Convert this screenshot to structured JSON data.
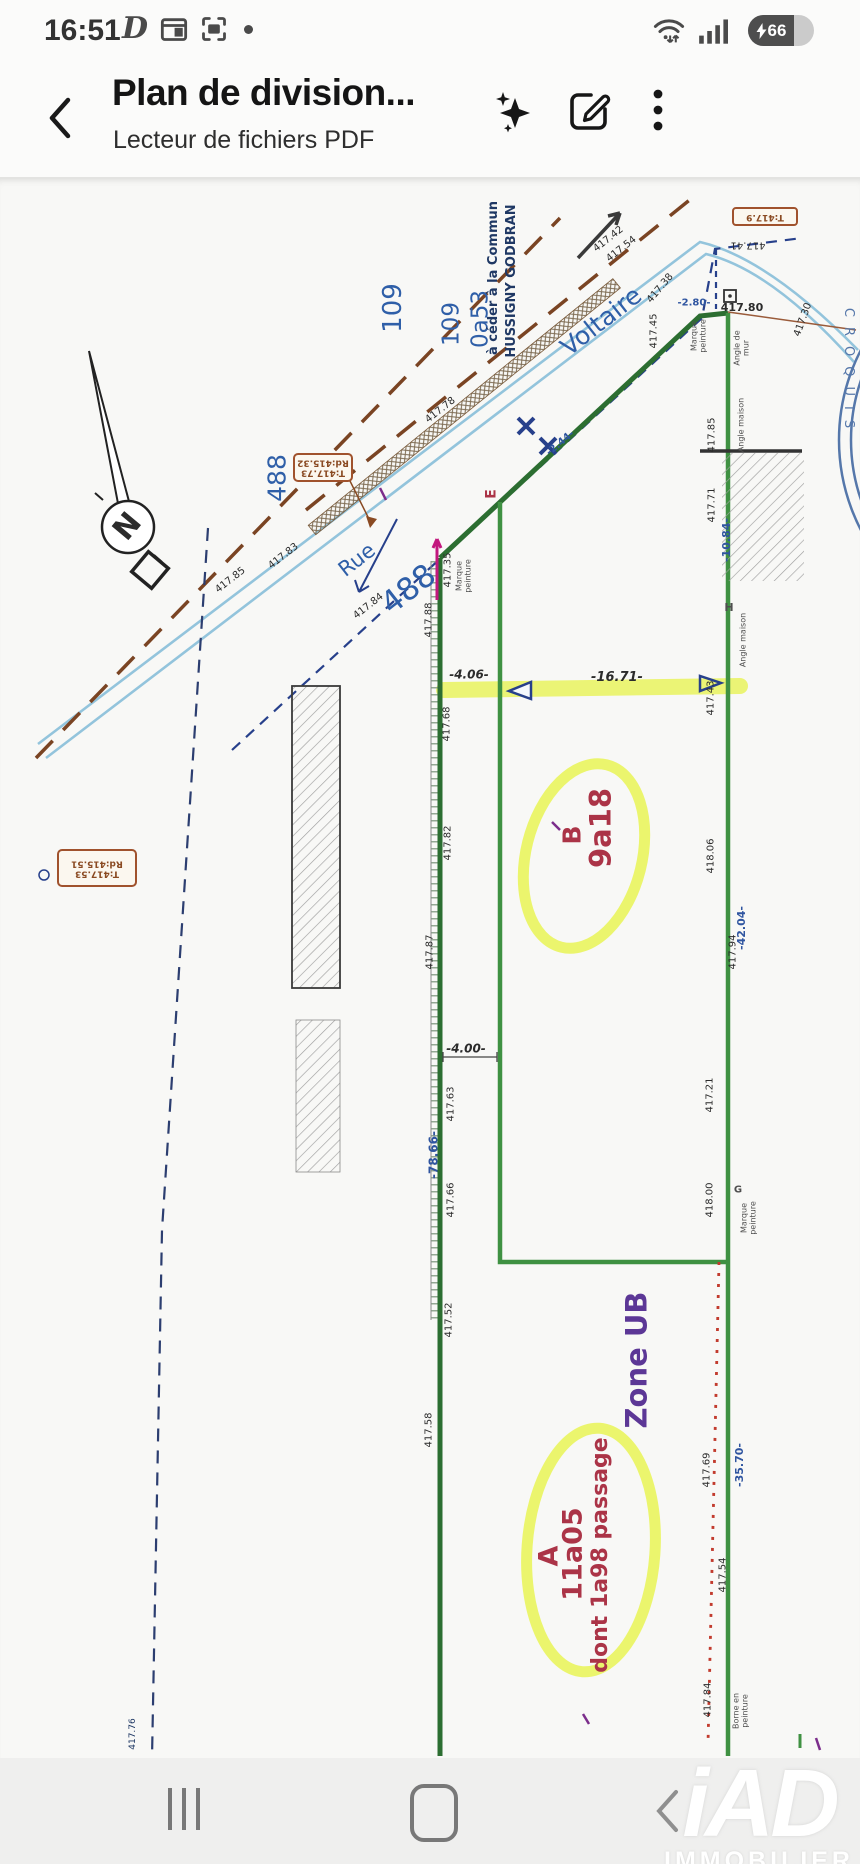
{
  "status_bar": {
    "time": "16:51",
    "battery_percent": "66"
  },
  "header": {
    "title": "Plan de division...",
    "subtitle": "Lecteur de fichiers PDF"
  },
  "watermark": {
    "brand": "iAD",
    "caption": "IMMOBILIER"
  },
  "colors": {
    "blue": "#2f5fa8",
    "navy": "#1f3864",
    "mblue": "#2f55a0",
    "red": "#ab3447",
    "purple": "#5c3796",
    "black": "#2b2b2b",
    "gray": "#4f4f4f",
    "brown": "#8a4a22",
    "stamp": "#5577aa",
    "boundary_green": "#2c6e31",
    "boundary_green_light": "#3f9142",
    "highlight_yellow": "#e9f455",
    "road_blue": "#93c4dc",
    "dashed_brown": "#7a4423",
    "red_dash": "#c23b2e",
    "magenta": "#c2187e"
  },
  "plan": {
    "labels": [
      {
        "t": "109",
        "x": 393,
        "y": 130,
        "r": -90,
        "s": 26,
        "c": "blue",
        "n": "parcel-109-a"
      },
      {
        "t": "109",
        "x": 452,
        "y": 146,
        "r": -90,
        "s": 23,
        "c": "blue",
        "n": "parcel-109-b"
      },
      {
        "t": "0a53",
        "x": 481,
        "y": 141,
        "r": -90,
        "s": 23,
        "c": "blue",
        "n": "parcel-0a53"
      },
      {
        "t": "à céder à la Commun",
        "x": 494,
        "y": 100,
        "r": -90,
        "s": 13,
        "c": "navy",
        "w": 600,
        "n": "note-a-ceder"
      },
      {
        "t": "HUSSIGNY GODBRAN",
        "x": 512,
        "y": 103,
        "r": -90,
        "s": 13,
        "c": "navy",
        "w": 700,
        "n": "note-hussigny"
      },
      {
        "t": "Voltaire",
        "x": 601,
        "y": 143,
        "r": -38,
        "s": 25,
        "c": "blue",
        "n": "street-voltaire"
      },
      {
        "t": "Rue",
        "x": 357,
        "y": 382,
        "r": -38,
        "s": 21,
        "c": "blue",
        "n": "street-rue"
      },
      {
        "t": "488",
        "x": 277,
        "y": 300,
        "r": -90,
        "s": 25,
        "c": "blue",
        "n": "parcel-488-a"
      },
      {
        "t": "488",
        "x": 409,
        "y": 412,
        "r": -38,
        "s": 31,
        "c": "blue",
        "n": "parcel-488-b"
      },
      {
        "t": "E",
        "x": 492,
        "y": 316,
        "r": -90,
        "s": 14,
        "c": "red",
        "w": 700,
        "n": "point-e"
      },
      {
        "t": "B",
        "x": 572,
        "y": 657,
        "r": -90,
        "s": 25,
        "c": "red",
        "w": 700,
        "n": "parcel-b"
      },
      {
        "t": "9a18",
        "x": 601,
        "y": 650,
        "r": -90,
        "s": 29,
        "c": "red",
        "w": 700,
        "n": "parcel-b-area"
      },
      {
        "t": "Zone UB",
        "x": 637,
        "y": 1182,
        "r": -90,
        "s": 29,
        "c": "purple",
        "w": 600,
        "n": "zone-ub"
      },
      {
        "t": "A",
        "x": 549,
        "y": 1378,
        "r": -90,
        "s": 27,
        "c": "red",
        "w": 700,
        "n": "parcel-a"
      },
      {
        "t": "11a05",
        "x": 573,
        "y": 1376,
        "r": -90,
        "s": 27,
        "c": "red",
        "w": 700,
        "n": "parcel-a-area"
      },
      {
        "t": "dont 1a98 passage",
        "x": 601,
        "y": 1377,
        "r": -90,
        "s": 22,
        "c": "red",
        "w": 700,
        "n": "parcel-a-passage"
      },
      {
        "t": "-4.06-",
        "x": 469,
        "y": 497,
        "r": 0,
        "s": 12,
        "c": "black",
        "w": 700,
        "i": 1,
        "n": "dim-4-06"
      },
      {
        "t": "-16.71-",
        "x": 617,
        "y": 500,
        "r": 0,
        "s": 13,
        "c": "black",
        "w": 700,
        "i": 1,
        "n": "dim-16-71"
      },
      {
        "t": "-4.00-",
        "x": 466,
        "y": 871,
        "r": 0,
        "s": 12,
        "c": "black",
        "w": 700,
        "i": 1,
        "n": "dim-4-00"
      },
      {
        "t": "-2.80-",
        "x": 694,
        "y": 126,
        "r": 0,
        "s": 10,
        "c": "mblue",
        "w": 700,
        "n": "dim-2-80"
      },
      {
        "t": "-2.44-",
        "x": 561,
        "y": 266,
        "r": -40,
        "s": 10,
        "c": "mblue",
        "w": 700,
        "n": "dim-2-44"
      },
      {
        "t": "-10.84-",
        "x": 727,
        "y": 362,
        "r": -90,
        "s": 11,
        "c": "mblue",
        "w": 700,
        "n": "dim-10-84"
      },
      {
        "t": "-42.04-",
        "x": 742,
        "y": 750,
        "r": -90,
        "s": 11,
        "c": "mblue",
        "w": 700,
        "n": "dim-42-04"
      },
      {
        "t": "-78.66-",
        "x": 434,
        "y": 977,
        "r": -90,
        "s": 12,
        "c": "mblue",
        "w": 700,
        "n": "dim-78-66"
      },
      {
        "t": "-35.70-",
        "x": 740,
        "y": 1287,
        "r": -90,
        "s": 11,
        "c": "mblue",
        "w": 700,
        "n": "dim-35-70"
      },
      {
        "t": "417.42",
        "x": 609,
        "y": 62,
        "r": -38,
        "s": 10,
        "c": "black"
      },
      {
        "t": "417.54",
        "x": 622,
        "y": 72,
        "r": -38,
        "s": 10,
        "c": "black"
      },
      {
        "t": "417.41",
        "x": 748,
        "y": 66,
        "r": 180,
        "s": 10,
        "c": "black"
      },
      {
        "t": "417.38",
        "x": 661,
        "y": 111,
        "r": -50,
        "s": 10,
        "c": "black"
      },
      {
        "t": "417.80",
        "x": 742,
        "y": 130,
        "r": 0,
        "s": 11,
        "c": "black",
        "w": 600
      },
      {
        "t": "417.30",
        "x": 804,
        "y": 142,
        "r": -70,
        "s": 10,
        "c": "black"
      },
      {
        "t": "417.45",
        "x": 655,
        "y": 153,
        "r": -90,
        "s": 10,
        "c": "black"
      },
      {
        "t": "Marque\npeinture",
        "x": 699,
        "y": 158,
        "r": -90,
        "s": 8,
        "c": "gray"
      },
      {
        "t": "Angle de\nmur",
        "x": 742,
        "y": 170,
        "r": -90,
        "s": 8,
        "c": "gray"
      },
      {
        "t": "Angle maison",
        "x": 742,
        "y": 247,
        "r": -90,
        "s": 8,
        "c": "gray"
      },
      {
        "t": "H",
        "x": 729,
        "y": 430,
        "r": 0,
        "s": 11,
        "c": "gray",
        "w": 700
      },
      {
        "t": "Angle maison",
        "x": 744,
        "y": 462,
        "r": -90,
        "s": 8,
        "c": "gray"
      },
      {
        "t": "417.85",
        "x": 713,
        "y": 257,
        "r": -90,
        "s": 10,
        "c": "black"
      },
      {
        "t": "417.71",
        "x": 713,
        "y": 327,
        "r": -90,
        "s": 10,
        "c": "black"
      },
      {
        "t": "417.43",
        "x": 712,
        "y": 520,
        "r": -90,
        "s": 10,
        "c": "black"
      },
      {
        "t": "418.06",
        "x": 712,
        "y": 678,
        "r": -90,
        "s": 10,
        "c": "black"
      },
      {
        "t": "417.94",
        "x": 734,
        "y": 774,
        "r": -90,
        "s": 10,
        "c": "black"
      },
      {
        "t": "417.21",
        "x": 711,
        "y": 917,
        "r": -90,
        "s": 10,
        "c": "black"
      },
      {
        "t": "418.00",
        "x": 711,
        "y": 1022,
        "r": -90,
        "s": 10,
        "c": "black"
      },
      {
        "t": "G",
        "x": 738,
        "y": 1013,
        "r": 0,
        "s": 10,
        "c": "gray",
        "w": 700
      },
      {
        "t": "Marque\npeinture",
        "x": 749,
        "y": 1040,
        "r": -90,
        "s": 8,
        "c": "gray"
      },
      {
        "t": "417.69",
        "x": 708,
        "y": 1292,
        "r": -90,
        "s": 10,
        "c": "black"
      },
      {
        "t": "417.54",
        "x": 724,
        "y": 1397,
        "r": -90,
        "s": 10,
        "c": "black"
      },
      {
        "t": "417.84",
        "x": 709,
        "y": 1522,
        "r": -90,
        "s": 10,
        "c": "black"
      },
      {
        "t": "Borne en\npeinture",
        "x": 741,
        "y": 1533,
        "r": -90,
        "s": 8,
        "c": "gray"
      },
      {
        "t": "417.78",
        "x": 441,
        "y": 233,
        "r": -38,
        "s": 10,
        "c": "black"
      },
      {
        "t": "417.83",
        "x": 284,
        "y": 379,
        "r": -38,
        "s": 10,
        "c": "black"
      },
      {
        "t": "417.85",
        "x": 231,
        "y": 403,
        "r": -38,
        "s": 10,
        "c": "black"
      },
      {
        "t": "417.84",
        "x": 369,
        "y": 429,
        "r": -38,
        "s": 10,
        "c": "black"
      },
      {
        "t": "417.35",
        "x": 449,
        "y": 392,
        "r": -90,
        "s": 10,
        "c": "black"
      },
      {
        "t": "Marque\npeinture",
        "x": 464,
        "y": 398,
        "r": -90,
        "s": 8,
        "c": "gray"
      },
      {
        "t": "417.88",
        "x": 430,
        "y": 442,
        "r": -90,
        "s": 10,
        "c": "black"
      },
      {
        "t": "417.68",
        "x": 448,
        "y": 546,
        "r": -90,
        "s": 10,
        "c": "black"
      },
      {
        "t": "417.82",
        "x": 449,
        "y": 665,
        "r": -90,
        "s": 10,
        "c": "black"
      },
      {
        "t": "417.87",
        "x": 431,
        "y": 774,
        "r": -90,
        "s": 10,
        "c": "black"
      },
      {
        "t": "417.63",
        "x": 452,
        "y": 926,
        "r": -90,
        "s": 10,
        "c": "black"
      },
      {
        "t": "417.66",
        "x": 452,
        "y": 1022,
        "r": -90,
        "s": 10,
        "c": "black"
      },
      {
        "t": "417.52",
        "x": 450,
        "y": 1142,
        "r": -90,
        "s": 10,
        "c": "black"
      },
      {
        "t": "417.58",
        "x": 430,
        "y": 1252,
        "r": -90,
        "s": 10,
        "c": "black"
      },
      {
        "t": "417.76",
        "x": 134,
        "y": 1556,
        "r": -90,
        "s": 9,
        "c": "navy"
      },
      {
        "t": "T:417.73\nRd:415.32",
        "x": 323,
        "y": 289,
        "r": 180,
        "s": 9,
        "c": "brown",
        "w": 600,
        "n": "cartouche-488"
      },
      {
        "t": "T:417.53\nRd:415.51",
        "x": 97,
        "y": 690,
        "r": 180,
        "s": 9,
        "c": "brown",
        "w": 600,
        "n": "cartouche-left"
      },
      {
        "t": "T:417.9",
        "x": 765,
        "y": 38,
        "r": 180,
        "s": 9,
        "c": "brown",
        "w": 600,
        "n": "cartouche-top"
      },
      {
        "t": "CROQUIS",
        "x": 848,
        "y": 195,
        "r": 90,
        "s": 13,
        "c": "stamp",
        "ls": 10,
        "n": "stamp-croquis"
      },
      {
        "t": "N",
        "x": 128,
        "y": 349,
        "r": -50,
        "s": 30,
        "c": "black",
        "w": 700,
        "n": "north-letter"
      }
    ]
  }
}
